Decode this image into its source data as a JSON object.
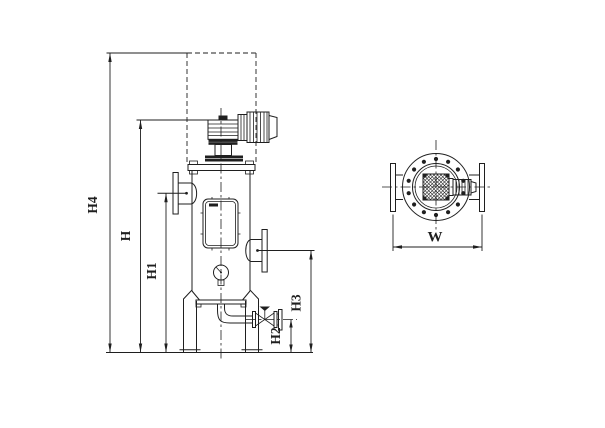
{
  "drawing": {
    "dimension_labels": {
      "h4": "H4",
      "h": "H",
      "h1": "H1",
      "h2": "H2",
      "h3": "H3",
      "w": "W"
    },
    "colors": {
      "line": "#1f1f1f",
      "background": "#ffffff"
    }
  }
}
